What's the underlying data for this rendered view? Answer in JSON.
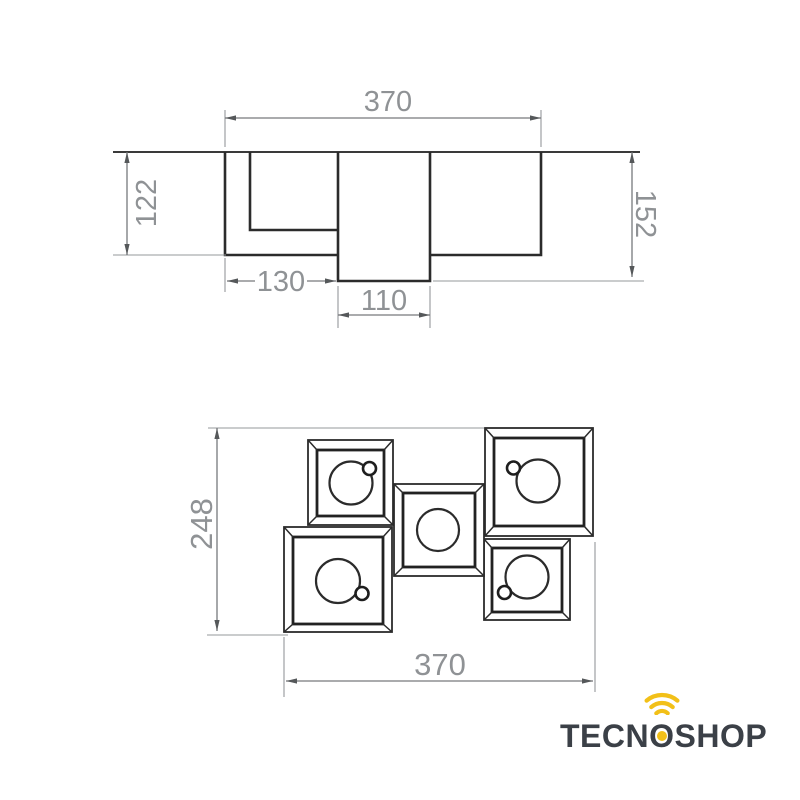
{
  "side_view": {
    "width": "370",
    "height_left": "122",
    "height_right": "152",
    "left_section_width": "130",
    "canopy_width": "110"
  },
  "plan_view": {
    "height": "248",
    "width": "370"
  },
  "logo": {
    "brand_full": "TECNOSHOP",
    "brand_prefix": "TECN",
    "brand_o": "O",
    "brand_suffix": "SHOP",
    "accent_color": "#f2c018",
    "text_color": "#3b4047"
  },
  "colors": {
    "drawing_line": "#2b2b2b",
    "dimension_line": "#77797c",
    "dimension_text": "#8f9295",
    "background": "#ffffff"
  }
}
